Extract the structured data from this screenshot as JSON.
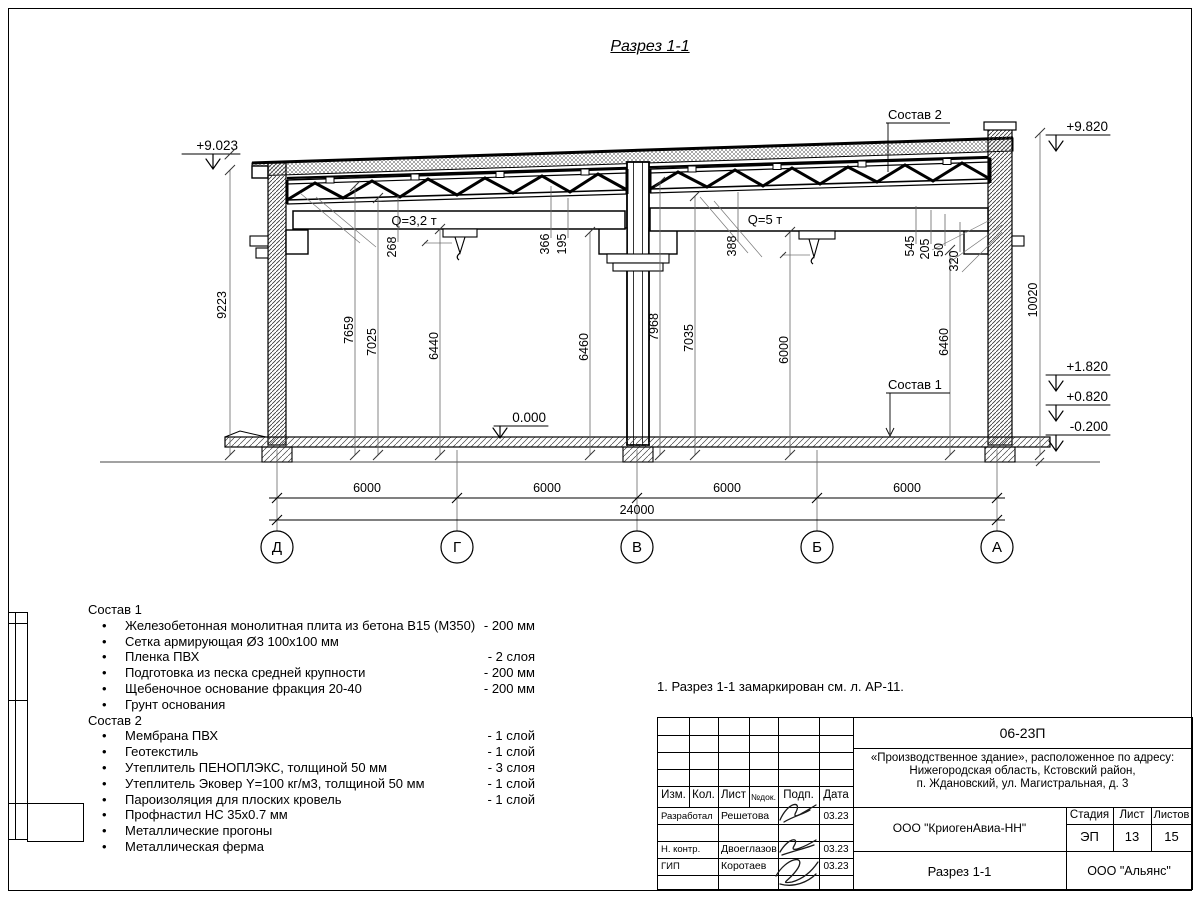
{
  "title": "Разрез 1-1",
  "section": {
    "elev_left": "+9.023",
    "elev_right_top": "+9.820",
    "elev_182": "+1.820",
    "elev_082": "+0.820",
    "elev_m02": "-0.200",
    "elev_floor": "0.000",
    "crane_left": "Q=3,2 т",
    "crane_right": "Q=5 т",
    "sostav1_label": "Состав 1",
    "sostav2_label": "Состав 2",
    "dims": {
      "d9223": "9223",
      "d268": "268",
      "d7659": "7659",
      "d7025": "7025",
      "d6440": "6440",
      "d366": "366",
      "d195": "195",
      "d6460l": "6460",
      "d388": "388",
      "d7968": "7968",
      "d7035": "7035",
      "d6000": "6000",
      "d545": "545",
      "d205": "205",
      "d50": "50",
      "d320": "320",
      "d6460r": "6460",
      "d10020": "10020"
    },
    "bottom": {
      "span1": "6000",
      "span2": "6000",
      "span3": "6000",
      "span4": "6000",
      "total": "24000"
    },
    "axes": {
      "a1": "Д",
      "a2": "Г",
      "a3": "В",
      "a4": "Б",
      "a5": "А"
    }
  },
  "sostav1": {
    "header": "Состав 1",
    "items": [
      {
        "text": "Железобетонная монолитная плита из бетона В15 (М350)",
        "qty": "-  200 мм"
      },
      {
        "text": "Сетка армирующая Ø3 100х100 мм",
        "qty": ""
      },
      {
        "text": "Пленка ПВХ",
        "qty": "-  2 слоя"
      },
      {
        "text": "Подготовка из песка средней крупности",
        "qty": "- 200 мм"
      },
      {
        "text": "Щебеночное основание фракция 20-40",
        "qty": "- 200 мм"
      },
      {
        "text": "Грунт основания",
        "qty": ""
      }
    ]
  },
  "sostav2": {
    "header": "Состав 2",
    "items": [
      {
        "text": "Мембрана ПВХ",
        "qty": "- 1 слой"
      },
      {
        "text": "Геотекстиль",
        "qty": "- 1 слой"
      },
      {
        "text": "Утеплитель ПЕНОПЛЭКС, толщиной 50 мм",
        "qty": "- 3 слоя"
      },
      {
        "text": "Утеплитель Эковер Y=100 кг/м3, толщиной 50 мм",
        "qty": "- 1 слой"
      },
      {
        "text": "Пароизоляция для плоских кровель",
        "qty": "- 1 слой"
      },
      {
        "text": "Профнастил НС 35х0.7 мм",
        "qty": ""
      },
      {
        "text": "Металлические прогоны",
        "qty": ""
      },
      {
        "text": "Металлическая ферма",
        "qty": ""
      }
    ]
  },
  "note": "1. Разрез 1-1 замаркирован см. л. АР-11.",
  "titleblock": {
    "doc_number": "06-23П",
    "address_line1": "«Производственное здание», расположенное по адресу:",
    "address_line2": "Нижегородская область, Кстовский район,",
    "address_line3": "п. Ждановский, ул. Магистральная, д. 3",
    "header": {
      "izm": "Изм.",
      "kol": "Кол.",
      "list": "Лист",
      "ndok": "№док.",
      "podp": "Подп.",
      "data": "Дата"
    },
    "rows": [
      {
        "role": "Разработал",
        "name": "Решетова",
        "date": "03.23"
      },
      {
        "role": "Н. контр.",
        "name": "Двоеглазов",
        "date": "03.23"
      },
      {
        "role": "ГИП",
        "name": "Коротаев",
        "date": "03.23"
      }
    ],
    "org": "ООО \"КриогенАвиа-НН\"",
    "stage_label": "Стадия",
    "sheet_label": "Лист",
    "sheets_label": "Листов",
    "stage": "ЭП",
    "sheet": "13",
    "sheets": "15",
    "section_name": "Разрез 1-1",
    "company": "ООО \"Альянс\""
  }
}
